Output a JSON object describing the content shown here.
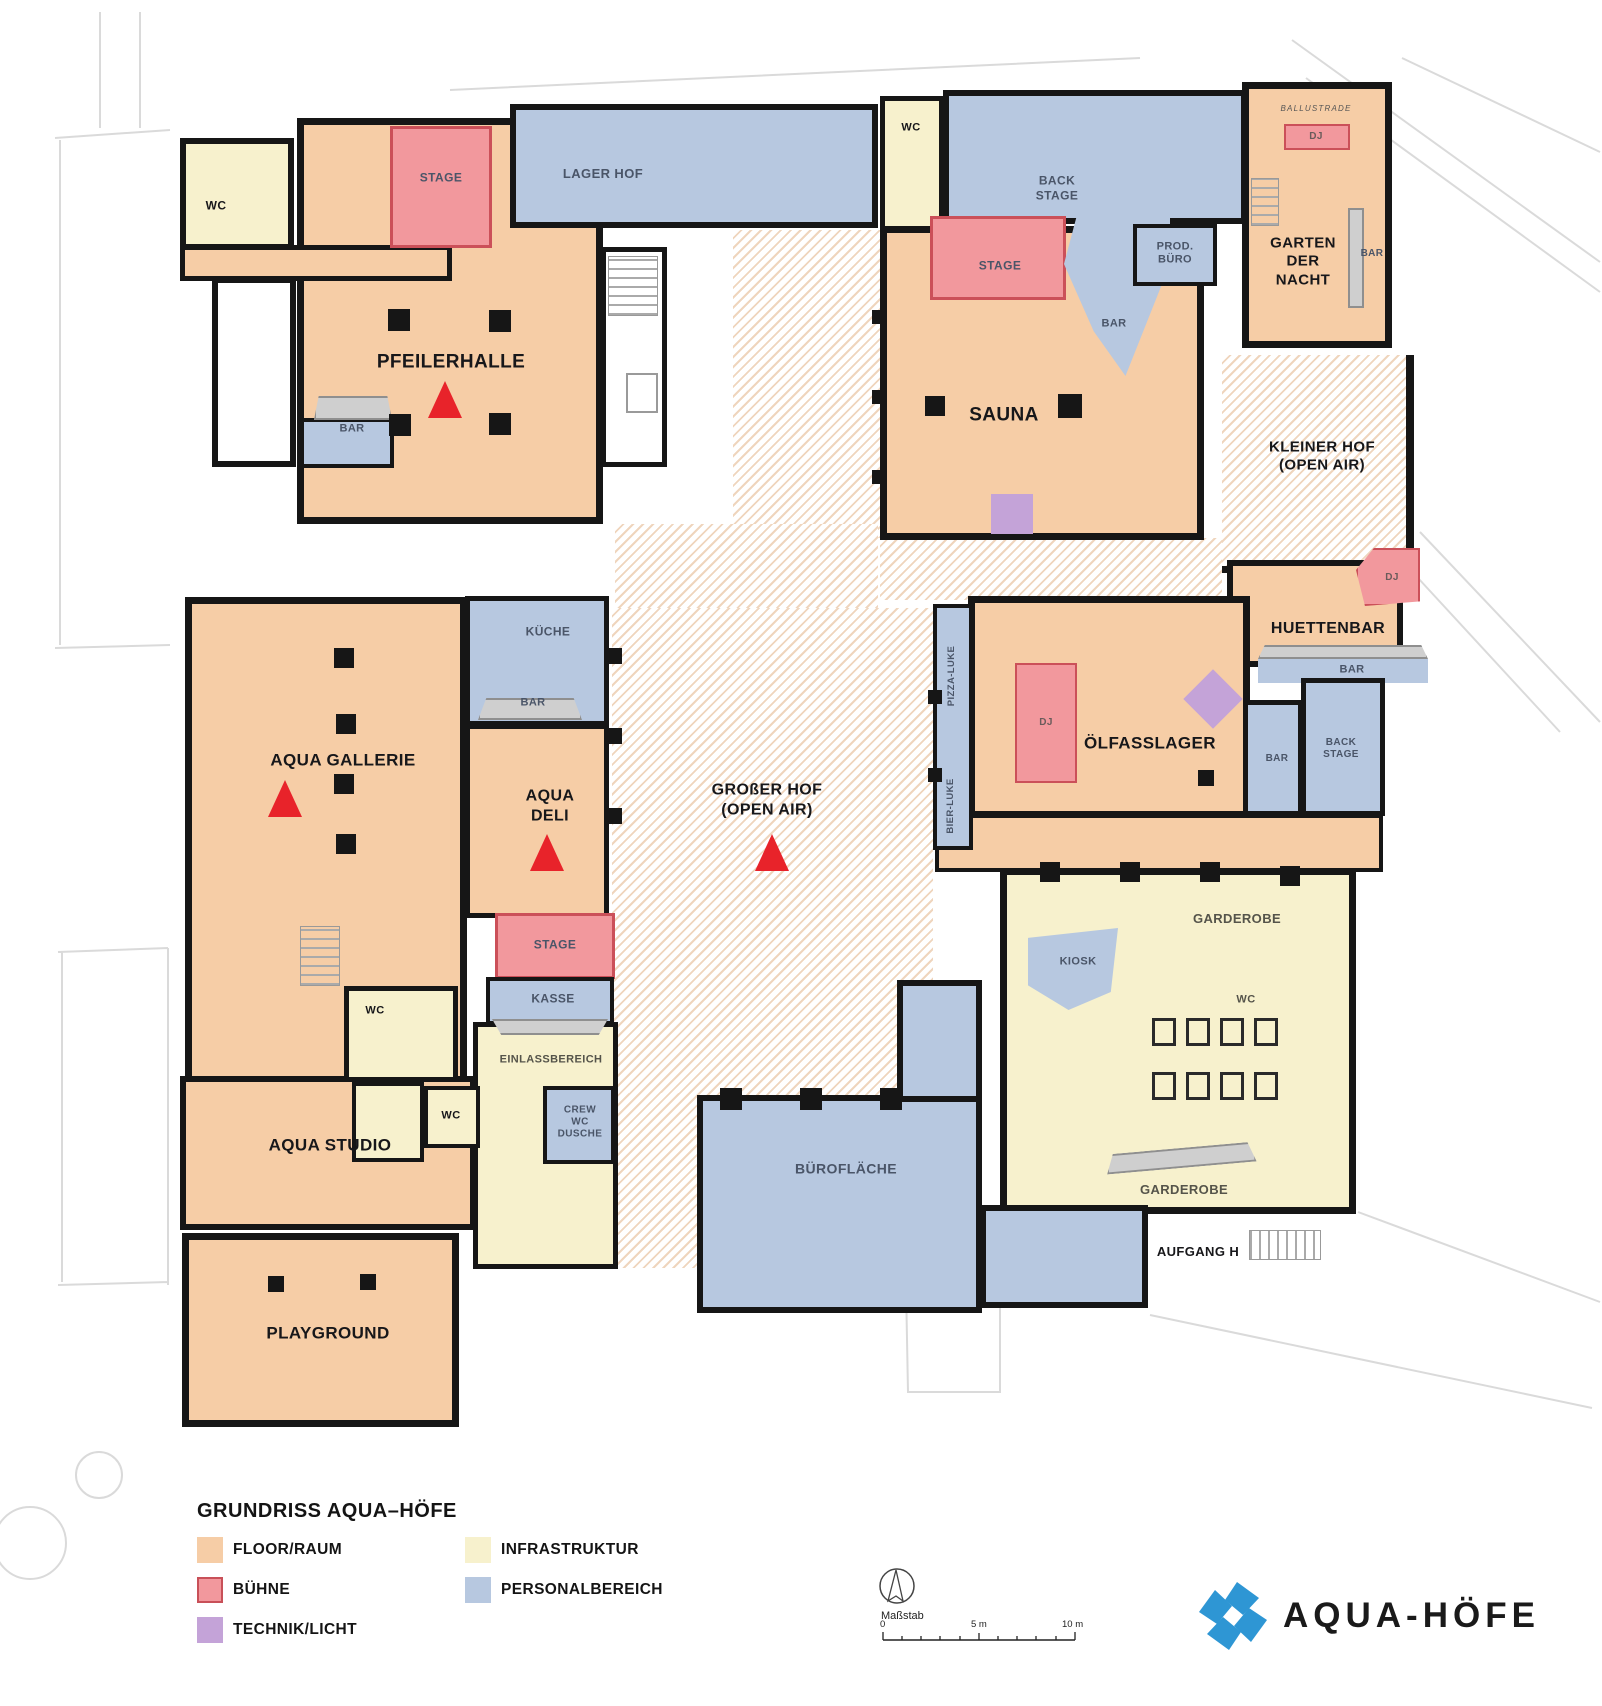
{
  "rooms": {
    "wc_nw": "WC",
    "stage_nw": "STAGE",
    "lager_hof": "LAGER HOF",
    "pfeilerhalle": "PFEILERHALLE",
    "bar_pfeilerhalle": "BAR",
    "wc_n": "WC",
    "back_stage_n": "BACK\nSTAGE",
    "stage_sauna": "STAGE",
    "prod_buero": "PROD.\nBÜRO",
    "bar_sauna": "BAR",
    "sauna": "SAUNA",
    "ballustrade": "BALLUSTRADE",
    "dj_garten": "DJ",
    "garten_der_nacht": "GARTEN\nDER\nNACHT",
    "bar_garten": "BAR",
    "kleiner_hof": "KLEINER HOF\n(OPEN AIR)",
    "huettenbar": "HUETTENBAR",
    "dj_huettenbar": "DJ",
    "bar_huettenbar": "BAR",
    "back_stage_huetten": "BACK\nSTAGE",
    "bar_huetten_side": "BAR",
    "oelfasslager": "ÖLFASSLAGER",
    "dj_oelfasslager": "DJ",
    "pizza_luke": "PIZZA-LUKE",
    "bier_luke": "BIER-LUKE",
    "kueche": "KÜCHE",
    "bar_kueche": "BAR",
    "aqua_gallerie": "AQUA GALLERIE",
    "aqua_deli": "AQUA\nDELI",
    "grosser_hof": "GROßER HOF\n(OPEN AIR)",
    "stage_deli": "STAGE",
    "kasse": "KASSE",
    "einlassbereich": "EINLASSBEREICH",
    "crew_wc_dusche": "CREW\nWC\nDUSCHE",
    "wc_mitte": "WC",
    "wc_studio": "WC",
    "aqua_studio": "AQUA STUDIO",
    "playground": "PLAYGROUND",
    "buroflaeche": "BÜROFLÄCHE",
    "garderobe_nord": "GARDEROBE",
    "kiosk": "KIOSK",
    "wc_garderobe": "WC",
    "garderobe_sued": "GARDEROBE",
    "aufgang_h": "AUFGANG H"
  },
  "legend": {
    "title": "GRUNDRISS AQUA–HÖFE",
    "items": [
      {
        "label": "FLOOR/RAUM",
        "color": "#f6cda6"
      },
      {
        "label": "BÜHNE",
        "color": "#f2989d"
      },
      {
        "label": "TECHNIK/LICHT",
        "color": "#c4a3d8"
      },
      {
        "label": "INFRASTRUKTUR",
        "color": "#f7f1cd"
      },
      {
        "label": "PERSONALBEREICH",
        "color": "#b7c8e0"
      }
    ]
  },
  "scalebar": {
    "label": "Maßstab",
    "ticks": [
      "0",
      "5 m",
      "10 m"
    ]
  },
  "logo": {
    "wordmark": "AQUA-HÖFE"
  },
  "markers": {
    "color": "#e8232a",
    "locations": [
      "pfeilerhalle",
      "aqua-gallerie",
      "aqua-deli",
      "grosser-hof"
    ]
  },
  "colors": {
    "wall": "#161616",
    "floor_raum": "#f6cda6",
    "buehne": "#f2989d",
    "buehne_border": "#cb5059",
    "technik_licht": "#c4a3d8",
    "infrastruktur": "#f7f1cd",
    "personalbereich": "#b7c8e0",
    "hatch_stripe": "#efd5bd",
    "marker_red": "#e8232a",
    "counter_gray": "#cfcfcf",
    "logo_blue": "#2e96d4"
  }
}
